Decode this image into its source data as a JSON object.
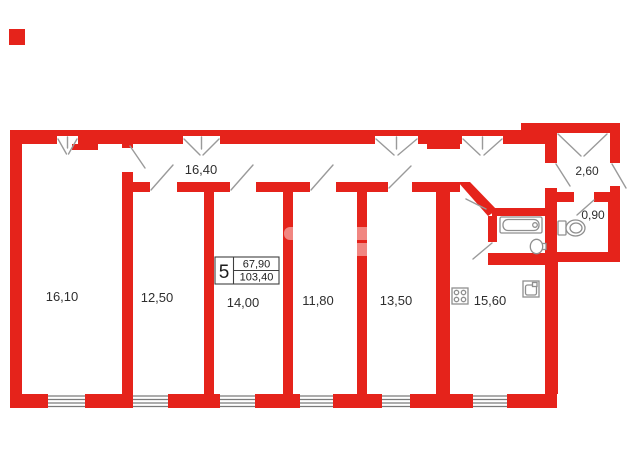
{
  "plan": {
    "unit_box": {
      "number": "5",
      "upper_area": "67,90",
      "lower_area": "103,40"
    },
    "rooms": [
      {
        "id": "room-1",
        "area": "16,10"
      },
      {
        "id": "room-2",
        "area": "12,50"
      },
      {
        "id": "room-3",
        "area": "14,00"
      },
      {
        "id": "room-4",
        "area": "11,80"
      },
      {
        "id": "room-5",
        "area": "13,50"
      },
      {
        "id": "kitchen",
        "area": "15,60"
      },
      {
        "id": "hallway",
        "area": "16,40"
      },
      {
        "id": "closet",
        "area": "2,60"
      },
      {
        "id": "wc",
        "area": "0,90"
      }
    ],
    "colors": {
      "wall": "#e5231b",
      "door_line": "#9a9a9a",
      "fixture_line": "#8f8f8f",
      "text": "#2e2e2e"
    }
  }
}
